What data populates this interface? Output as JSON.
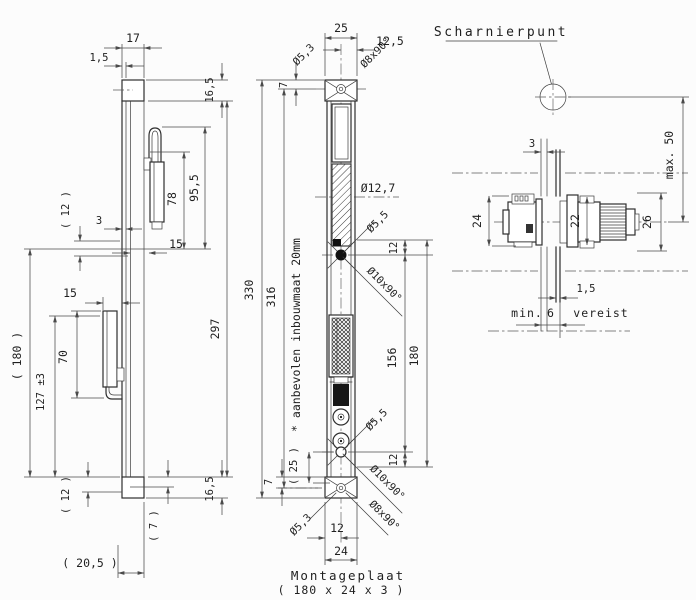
{
  "drawing": {
    "side": {
      "dims": {
        "w17": "17",
        "t1_5": "1,5",
        "h16_5_top": "16,5",
        "h95_5": "95,5",
        "h78": "78",
        "g12_top": "( 12 )",
        "g3": "3",
        "o15_top": "15",
        "h297": "297",
        "l180": "( 180 )",
        "o15_bot": "15",
        "h70": "70",
        "p127": "127 ±3",
        "g12_bot": "( 12 )",
        "g7": "( 7 )",
        "h16_5_bot": "16,5",
        "d20_5": "( 20,5 )"
      }
    },
    "front": {
      "dims": {
        "w25": "25",
        "w12_5": "12,5",
        "hole5_3_top": "Ø5,3",
        "csk8_top": "Ø8x90°",
        "e7_top": "7",
        "h330": "330",
        "h316": "316",
        "roller": "Ø12,7",
        "hole5_5_top": "Ø5,5",
        "csk10_top": "Ø10x90°",
        "o12_top": "12",
        "h156": "156",
        "h180": "180",
        "hole5_5_bot": "Ø5,5",
        "csk10_bot": "Ø10x90°",
        "o25": "( 25 )",
        "o12_bot": "12",
        "e7_bot": "7",
        "hole5_3_bot": "Ø5,3",
        "csk8_bot": "Ø8x90°",
        "w12": "12",
        "w24": "24"
      },
      "note": "* aanbevolen inbouwmaat 20mm",
      "caption_title": "Montageplaat",
      "caption_size": "( 180 x 24 x 3 )"
    },
    "section": {
      "label": "Scharnierpunt",
      "dims": {
        "max50": "max. 50",
        "g3": "3",
        "h24": "24",
        "h22": "22",
        "h26": "26",
        "t1_5": "1,5",
        "min_label": "min.",
        "min6": "6",
        "vereist": "vereist"
      }
    }
  }
}
